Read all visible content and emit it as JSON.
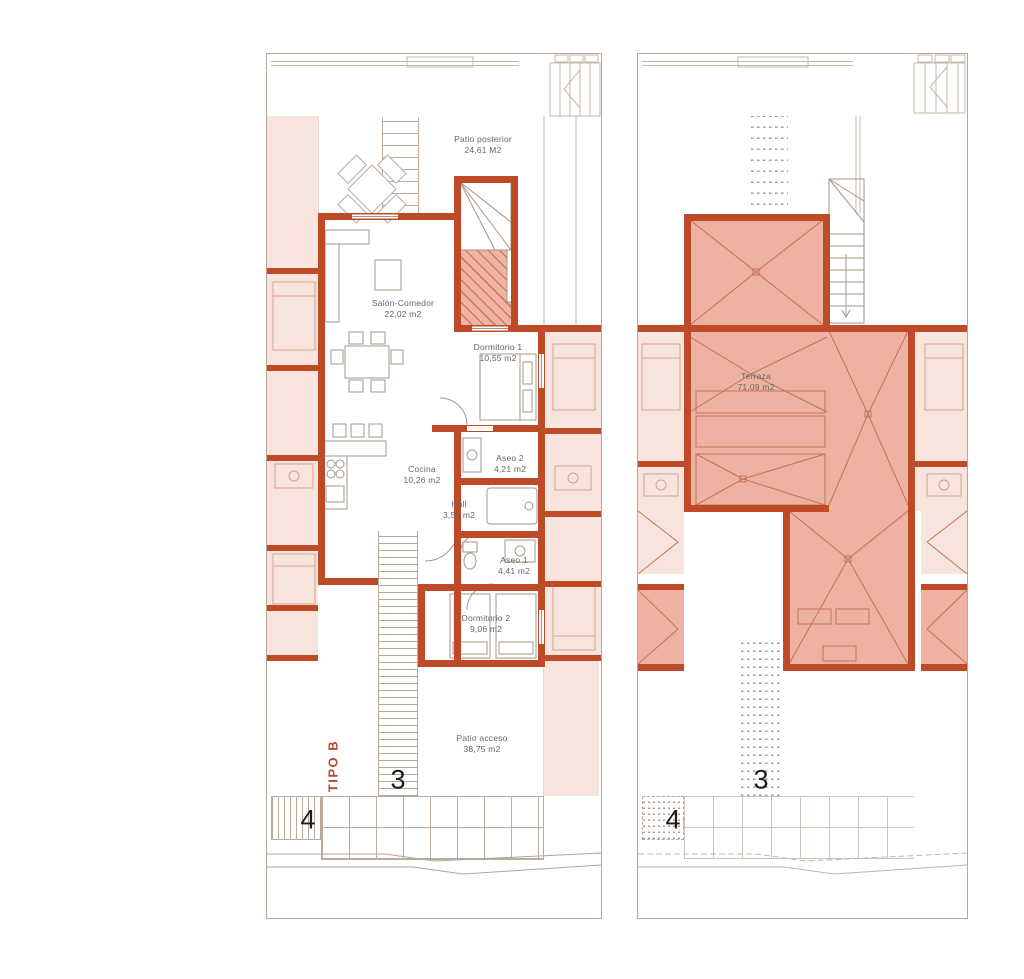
{
  "drawing": {
    "kind": "floor-plan",
    "type_label": "TIPO B",
    "colors": {
      "wall": "#bf4a27",
      "roof_fill": "#edb2a2",
      "neighbor_fill": "#f7e4dd",
      "line": "#b6a99c",
      "label_text": "#6b655e",
      "accent_text": "#b5492f"
    }
  },
  "left_plan": {
    "type_label": "TIPO B",
    "unit_number": "3",
    "adjacent_unit_number": "4",
    "rooms": [
      {
        "label": "Patio posterior",
        "area": "24,61 M2"
      },
      {
        "label": "Salón-Comedor",
        "area": "22,02 m2"
      },
      {
        "label": "Dormitorio 1",
        "area": "10,55 m2"
      },
      {
        "label": "Cocina",
        "area": "10,26 m2"
      },
      {
        "label": "Aseo 2",
        "area": "4,21 m2"
      },
      {
        "label": "Hall",
        "area": "3,53 m2"
      },
      {
        "label": "Aseo 1",
        "area": "4,41 m2"
      },
      {
        "label": "Dormitorio 2",
        "area": "9,06 m2"
      },
      {
        "label": "Patio acceso",
        "area": "38,75 m2"
      }
    ]
  },
  "right_plan": {
    "unit_number": "3",
    "adjacent_unit_number": "4",
    "rooms": [
      {
        "label": "Terraza",
        "area": "71,09 m2"
      }
    ]
  }
}
